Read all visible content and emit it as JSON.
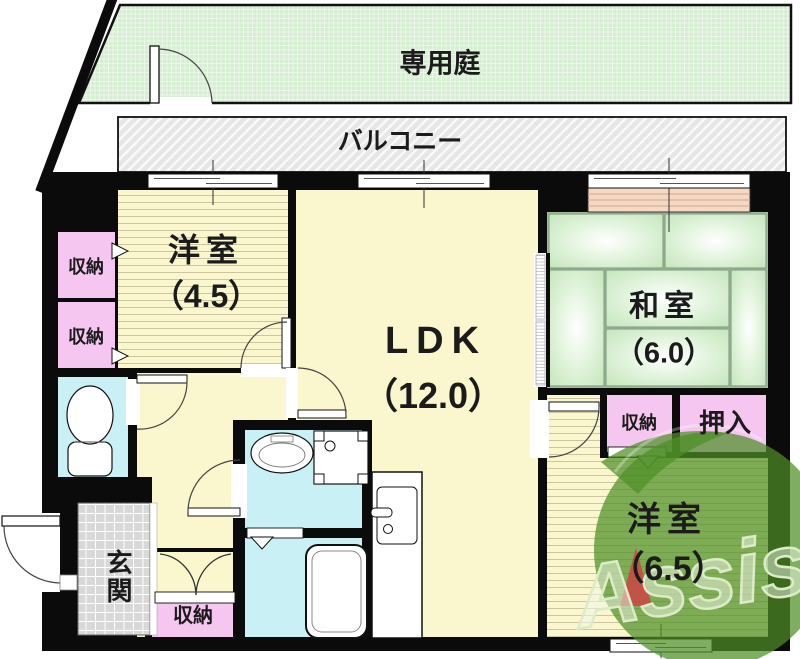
{
  "plan": {
    "garden": {
      "label": "専用庭"
    },
    "balcony": {
      "label": "バルコニー"
    },
    "western_room_small": {
      "label": "洋室",
      "size": "（4.5）"
    },
    "ldk": {
      "label": "LDK",
      "size": "（12.0）"
    },
    "japanese_room": {
      "label": "和室",
      "size": "（6.0）"
    },
    "western_room_large": {
      "label": "洋室",
      "size": "（6.5）"
    },
    "entrance": {
      "label": "玄関"
    },
    "storage_upper_left_1": {
      "label": "収納"
    },
    "storage_upper_left_2": {
      "label": "収納"
    },
    "storage_center_right": {
      "label": "収納"
    },
    "oshiire": {
      "label": "押入"
    },
    "storage_hallway": {
      "label": "収納"
    }
  },
  "watermark": {
    "text": "Assist"
  },
  "colors": {
    "wall": "#0b0b0b",
    "floor_yellow": "#faf6cd",
    "tatami_green": "#cbe9c4",
    "garden_green": "#d6eed2",
    "closet_pink": "#f5c6ef",
    "wet_area_cyan": "#c9f0f5",
    "balcony_gray": "#e6e6e6",
    "shutter_salmon": "#f7d9c3",
    "logo_green": "#4e8f26",
    "logo_red": "#cc4444"
  }
}
